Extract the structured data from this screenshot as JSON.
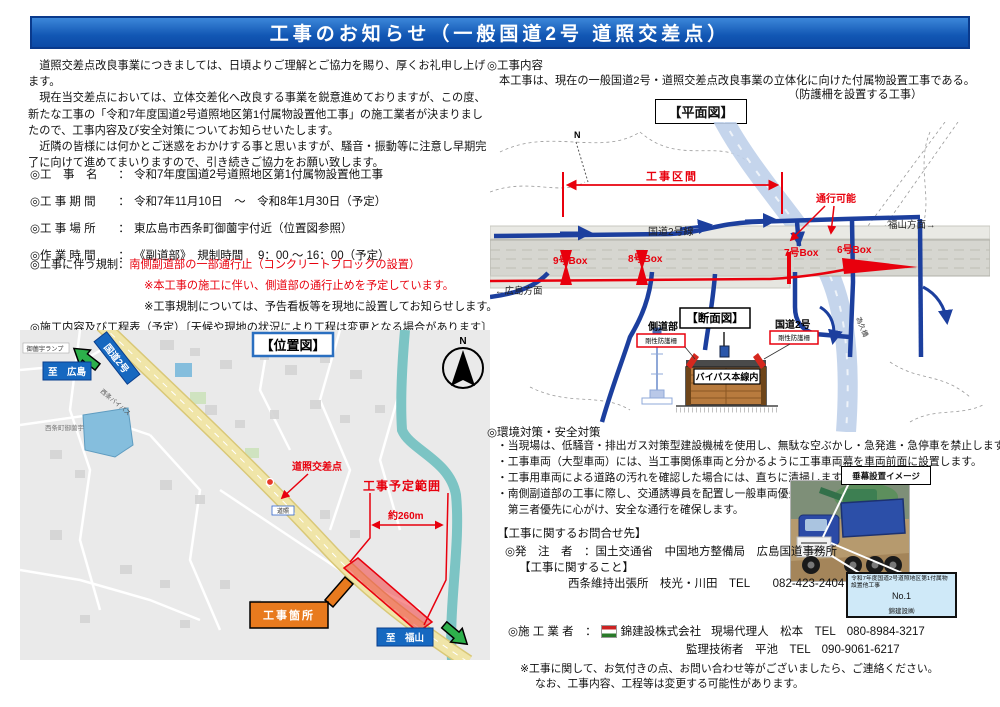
{
  "header": {
    "title": "工事のお知らせ（一般国道2号 道照交差点）"
  },
  "intro": {
    "l1": "　道照交差点改良事業につきましては、日頃よりご理解とご協力を賜り、厚くお礼申し上げます。",
    "l2": "　現在当交差点においては、立体交差化へ改良する事業を鋭意進めておりますが、この度、新たな工事の「令和7年度国道2号道照地区第1付属物設置他工事」の施工業者が決まりましたので、工事内容及び安全対策についてお知らせいたします。",
    "l3": "　近隣の皆様には何かとご迷惑をおかけする事と思いますが、騒音・振動等に注意し早期完了に向けて進めてまいりますので、引き続きご協力をお願い致します。"
  },
  "details": {
    "rows": [
      {
        "label": "◎工　事　名",
        "sep": "：",
        "value": "令和7年度国道2号道照地区第1付属物設置他工事"
      },
      {
        "label": "◎工 事 期 間",
        "sep": "：",
        "value": "令和7年11月10日　～　令和8年1月30日（予定）"
      },
      {
        "label": "◎工 事 場 所",
        "sep": "：",
        "value": "東広島市西条町御薗宇付近（位置図参照）"
      },
      {
        "label": "◎作 業 時 間",
        "sep": "：",
        "value": "《副道部》　規制時間　 9：00 ～ 16：00（予定）"
      }
    ]
  },
  "regulation": {
    "label": "◎工事に伴う規制：",
    "red1": "南側副道部の一部通行止（コンクリートブロックの設置）",
    "red2": "※本工事の施工に伴い、側道部の通行止めを予定しています。",
    "note": "※工事規制については、予告看板等を現地に設置してお知らせします。",
    "schedule": "◎施工内容及び工程表（予定）〔天候や現地の状況により工程は変更となる場合があります〕"
  },
  "map": {
    "title": "【位置図】",
    "ramp": "御薗宇ランプ",
    "to_hiroshima": "至　広島",
    "route": "国道2号",
    "bypass": "西条バイパス",
    "town": "西条町御薗宇",
    "crossing": "道照交差点",
    "crossing_small": "道照",
    "range": "工事予定範囲",
    "distance": "約260m",
    "site": "工事箇所",
    "to_fukuyama": "至　福山",
    "north": "N"
  },
  "content": {
    "heading": "◎工事内容",
    "desc": "本工事は、現在の一般国道2号・道照交差点改良事業の立体化に向けた付属物設置工事である。",
    "desc2": "（防護柵を設置する工事）"
  },
  "plan": {
    "title": "【平面図】",
    "section_range": "工事区間",
    "passable": "通行可能",
    "route": "国道2号線",
    "box9": "9号Box",
    "box8": "8号Box",
    "box7": "7号Box",
    "box6": "6号Box",
    "hiroshima": "←広島方面",
    "fukuyama": "福山方面→",
    "bridge": "為久橋",
    "north": "N"
  },
  "section": {
    "title": "【断面図】",
    "side_road": "側道部",
    "fence": "剛性防護柵",
    "route": "国道2号",
    "bypass": "バイパス本線内"
  },
  "env": {
    "heading": "◎環境対策・安全対策",
    "bullets": [
      "・当現場は、低騒音・排出ガス対策型建設機械を使用し、無駄な空ぶかし・急発進・急停車を禁止します。",
      "・工事車両（大型車両）には、当工事関係車両と分かるように工事車両幕を車両前面に設置します。",
      "・工事用車両による道路の汚れを確認した場合には、直ちに清掃します。",
      "・南側副道部の工事に際し、交通誘導員を配置し一般車両優先",
      "　第三者優先に心がけ、安全な通行を確保します。"
    ]
  },
  "banner": {
    "label": "垂幕設置イメージ"
  },
  "contact": {
    "heading": "【工事に関するお問合せ先】",
    "client_label": "◎発　注　者　：",
    "client": "国土交通省　中国地方整備局　広島国道事務所",
    "about": "【工事に関すること】",
    "office": "西条維持出張所　枝光・川田　TEL　　082-423-2404"
  },
  "sign": {
    "line1": "令和7年度国道2号道照地区第1付属物設置他工事",
    "number": "No.1",
    "company": "錦建設㈱"
  },
  "contractor": {
    "label": "◎施 工 業 者　：",
    "company": "錦建設株式会社",
    "rep": "現場代理人　松本　TEL　080-8984-3217",
    "engineer": "監理技術者　平池　TEL　090-9061-6217"
  },
  "notes": {
    "line1": "※工事に関して、お気付きの点、お問い合わせ等がございましたら、ご連絡ください。",
    "line2": "なお、工事内容、工程等は変更する可能性があります。"
  }
}
